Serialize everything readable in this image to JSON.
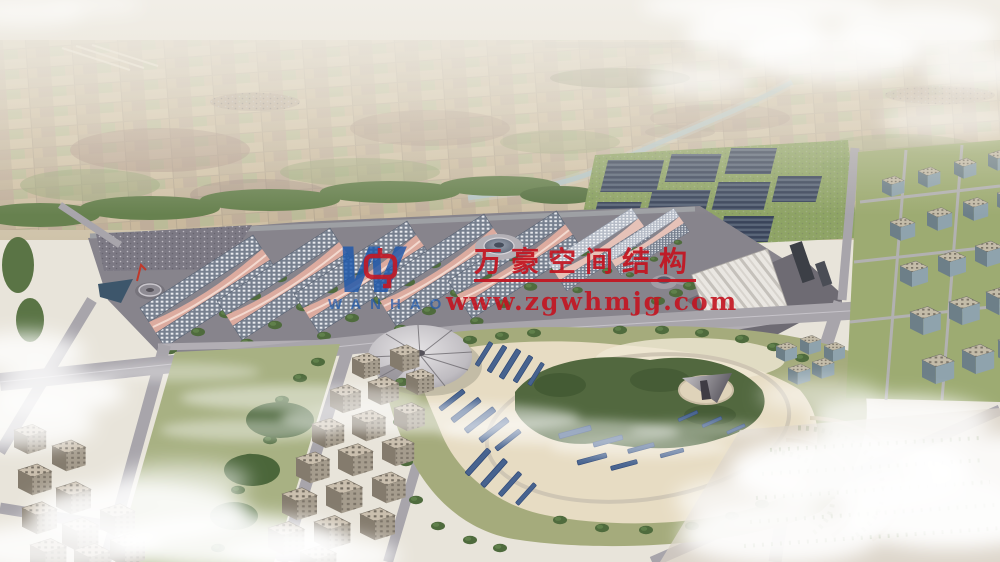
{
  "watermark": {
    "title": "万豪空间结构",
    "url": "www.zgwhmjg.com",
    "logo_letter": "W",
    "logo_subtext": "WANHAO"
  },
  "palette": {
    "brand_red": "#c41420",
    "brand_blue": "#1d58ac",
    "sky_haze": "#efece5",
    "farmland_tan": "#c9b89c",
    "field_green": "#9aa87c",
    "tree_green": "#4f6b3d",
    "solar_panel": "#3d4857",
    "roof_base": "#77808f",
    "roof_skylight": "#e8eaee",
    "crest_pink": "#dcab9f",
    "road_gray": "#a8a5ab",
    "plaza_sand": "#e7dcc3",
    "lawn_green": "#a5ab7c",
    "water_blue": "#3d566b",
    "cloud_white": "#ffffff"
  }
}
